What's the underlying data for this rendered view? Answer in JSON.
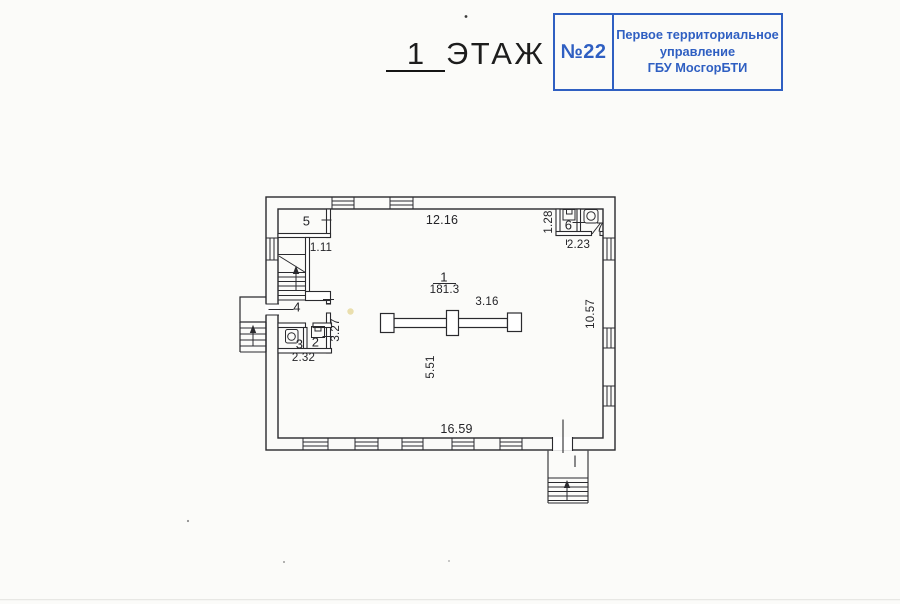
{
  "title": {
    "floor_number": "1",
    "floor_word": "ЭТАЖ"
  },
  "stamp": {
    "number": "№22",
    "organization": "Первое территориальное\nуправление\nГБУ МосгорБТИ",
    "accent_color": "#2f5fc2"
  },
  "plan": {
    "rooms": {
      "main": {
        "number": "1",
        "area": "181.3"
      },
      "room2": "2",
      "room3": "3",
      "room4": "4",
      "room5": "5",
      "room6": "6",
      "room7": "7"
    },
    "dimensions": {
      "top_wall": "12.16",
      "bottom_wall": "16.59",
      "right_wall": "10.57",
      "stair_lobby_width": "1.11",
      "wc_block_depth": "1.28",
      "wc_block_width": "2.23",
      "hall_block_depth": "3.27",
      "wc_row_width": "2.32",
      "column_spacing": "3.16",
      "hall_span": "5.51"
    }
  }
}
